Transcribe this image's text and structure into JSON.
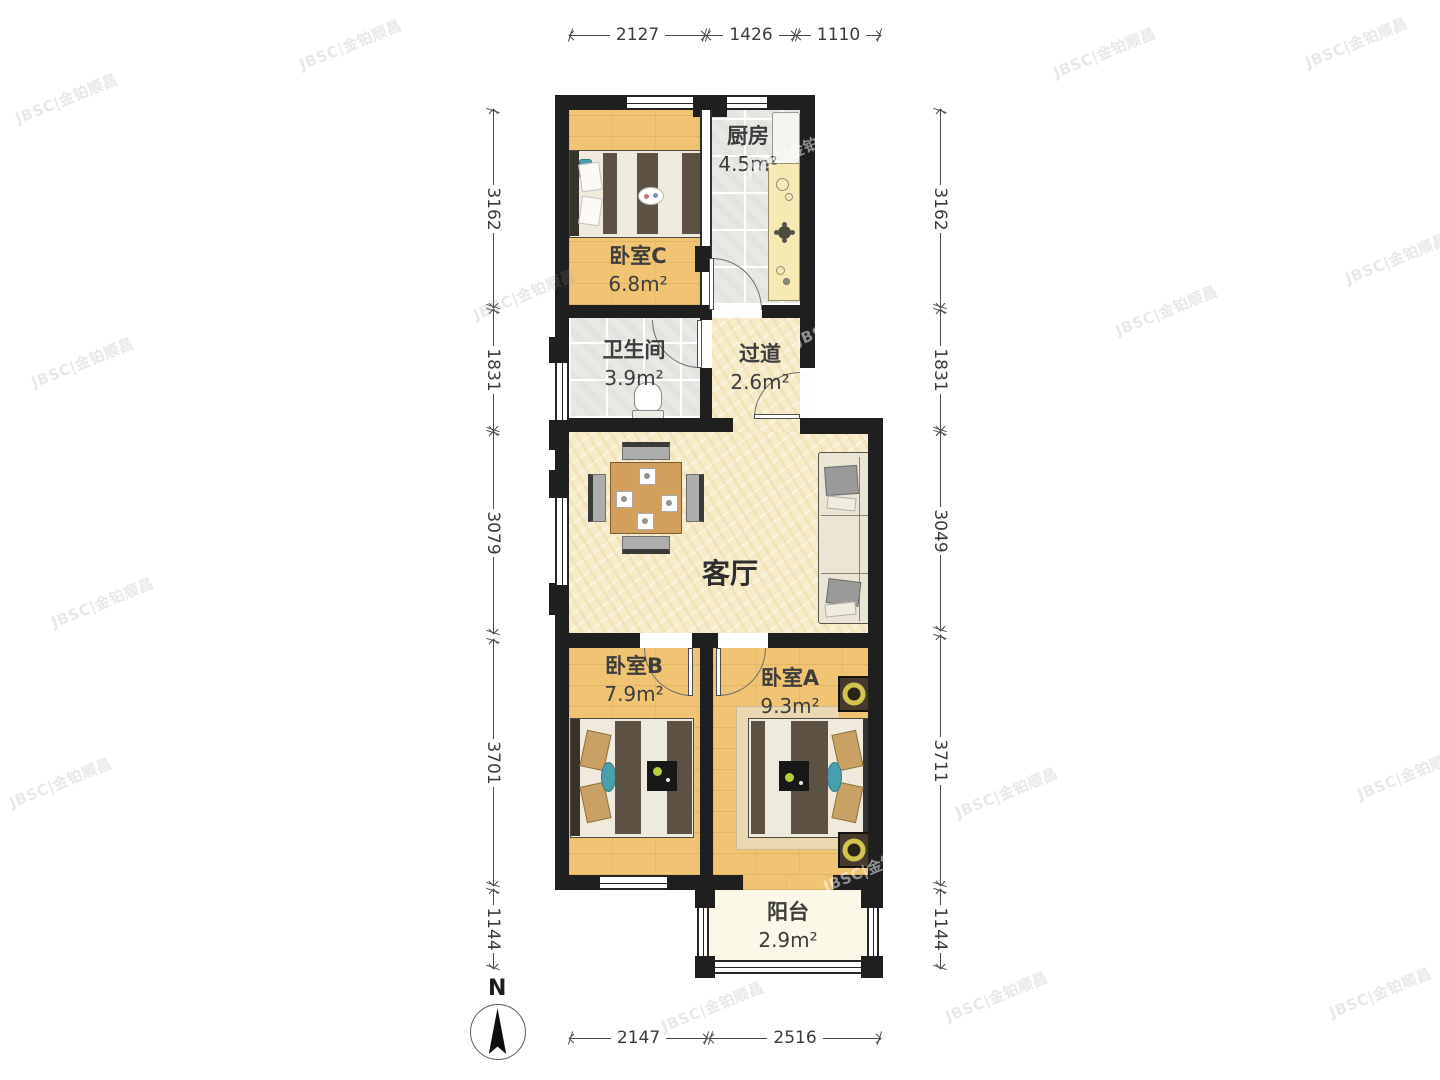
{
  "watermark": {
    "text": "JBSC|金铂顺昌"
  },
  "compass": {
    "north_label": "N"
  },
  "rooms": {
    "bedroomC": {
      "name": "卧室C",
      "area": "6.8m²"
    },
    "kitchen": {
      "name": "厨房",
      "area": "4.5m²"
    },
    "bathroom": {
      "name": "卫生间",
      "area": "3.9m²"
    },
    "hallway": {
      "name": "过道",
      "area": "2.6m²"
    },
    "living": {
      "name": "客厅"
    },
    "bedroomB": {
      "name": "卧室B",
      "area": "7.9m²"
    },
    "bedroomA": {
      "name": "卧室A",
      "area": "9.3m²"
    },
    "balcony": {
      "name": "阳台",
      "area": "2.9m²"
    }
  },
  "dimensions_mm": {
    "top": [
      "2127",
      "1426",
      "1110"
    ],
    "left": [
      "3162",
      "1831",
      "3079",
      "3701",
      "1144"
    ],
    "right": [
      "3162",
      "1831",
      "3049",
      "3711",
      "1144"
    ],
    "bottom": [
      "2147",
      "2516"
    ]
  },
  "colors": {
    "wall": "#1f1f1f",
    "wood_floor": "#f1c474",
    "tile_floor": "#e9e8e4",
    "living_floor": "#f7ecca",
    "balcony_floor": "#fbf8e7",
    "duvet": "#5d5144",
    "dimension_text": "#3b3b3b"
  }
}
